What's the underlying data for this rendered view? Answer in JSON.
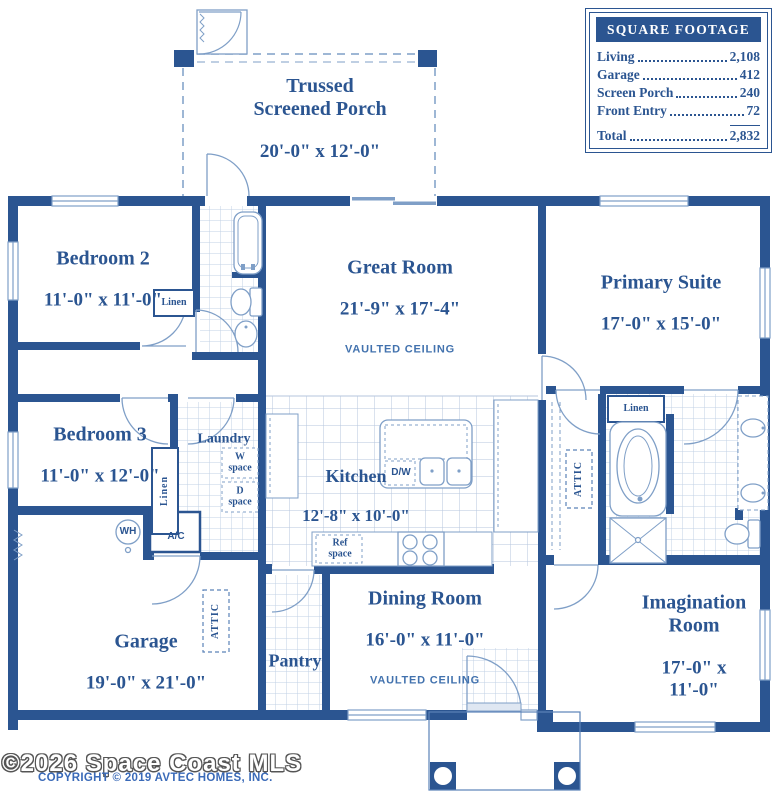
{
  "colors": {
    "wall_blue": "#2b5591",
    "fixture_blue": "#7f9fc7",
    "tile_blue": "#bac9df",
    "note_blue": "#4272ae",
    "watermark_outline": "#555555",
    "copyright_blue": "#3a6ab8"
  },
  "legend": {
    "title": "SQUARE FOOTAGE",
    "rows": [
      {
        "label": "Living",
        "value": "2,108"
      },
      {
        "label": "Garage",
        "value": "412"
      },
      {
        "label": "Screen Porch",
        "value": "240"
      },
      {
        "label": "Front Entry",
        "value": "72"
      }
    ],
    "total": {
      "label": "Total",
      "value": "2,832"
    }
  },
  "rooms": {
    "porch": {
      "name": "Trussed\nScreened Porch",
      "dims": "20'-0\" x 12'-0\""
    },
    "bedroom2": {
      "name": "Bedroom 2",
      "dims": "11'-0\" x 11'-0\""
    },
    "great_room": {
      "name": "Great Room",
      "dims": "21'-9\" x 17'-4\"",
      "note": "VAULTED CEILING"
    },
    "primary_suite": {
      "name": "Primary Suite",
      "dims": "17'-0\" x 15'-0\""
    },
    "bedroom3": {
      "name": "Bedroom 3",
      "dims": "11'-0\" x 12'-0\""
    },
    "laundry": {
      "name": "Laundry"
    },
    "kitchen": {
      "name": "Kitchen",
      "dims": "12'-8\" x 10'-0\""
    },
    "dining": {
      "name": "Dining Room",
      "dims": "16'-0\" x 11'-0\"",
      "note": "VAULTED CEILING"
    },
    "pantry": {
      "name": "Pantry"
    },
    "garage": {
      "name": "Garage",
      "dims": "19'-0\" x 21'-0\""
    },
    "imagination": {
      "name": "Imagination\nRoom",
      "dims": "17'-0\" x 11'-0\""
    }
  },
  "labels": {
    "linen": "Linen",
    "attic": "ATTIC",
    "water_heater": "WH",
    "ac": "A/C",
    "washer_space": "W\nspace",
    "dryer_space": "D\nspace",
    "ref_space": "Ref\nspace",
    "dishwasher": "D/W"
  },
  "watermark": {
    "line1": "©2026 Space Coast MLS",
    "line2": "COPYRIGHT © 2019 AVTEC HOMES, INC."
  }
}
